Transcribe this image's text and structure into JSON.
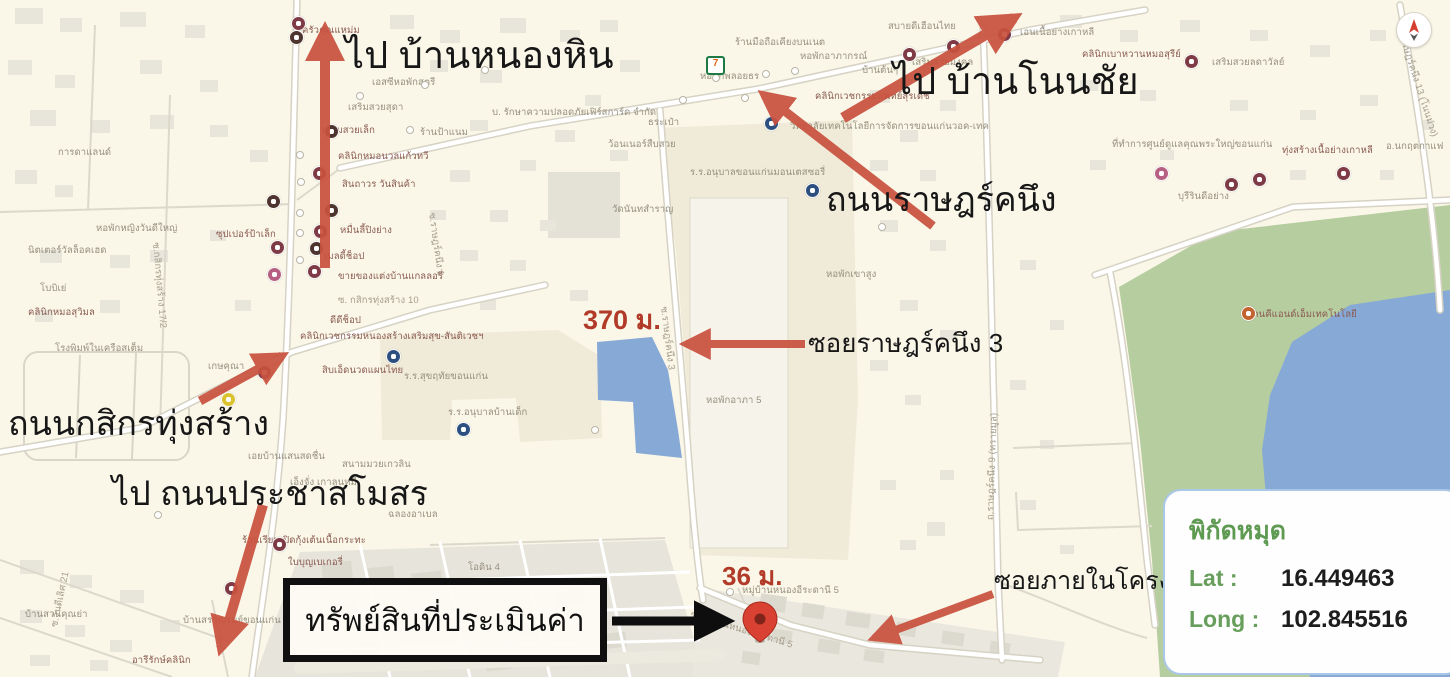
{
  "colors": {
    "background": "#faf7e9",
    "road": "#ffffff",
    "road_casing": "#dbd7ca",
    "building": "#e8e5db",
    "campus": "#f0ead8",
    "park": "#b6cd9f",
    "water": "#87a9d6",
    "arrow_red": "#c9523f",
    "arrow_black": "#0e0e0e",
    "pin_red": "#d94132",
    "annotation_red": "#b23a28",
    "coords_green": "#679e5b"
  },
  "annotations": {
    "to_ban_nong_hin": "ไป บ้านหนองหิน",
    "to_ban_non_chai": "ไป บ้านโนนชัย",
    "ratchakhanueng_road": "ถนนราษฎร์คนึง",
    "soi_ratchakhanueng_3": "ซอยราษฎร์คนึง 3",
    "distance_370": "370 ม.",
    "kasikorn_thungsang_road": "ถนนกสิกรทุ่งสร้าง",
    "to_pracha_samosorn": "ไป ถนนประชาสโมสร",
    "property_appraised": "ทรัพย์สินที่ประเมินค่า",
    "distance_36": "36 ม.",
    "soi_inside_project": "ซอยภายในโครงการ"
  },
  "coords_box": {
    "title": "พิกัดหมุด",
    "lat_label": "Lat :",
    "lat_value": "16.449463",
    "long_label": "Long :",
    "long_value": "102.845516"
  },
  "seven_eleven": {
    "x": 706,
    "y": 56,
    "glyph": "7"
  },
  "poi_colors": {
    "m": "#7e3a45",
    "b": "#4e342e",
    "p": "#b75f82",
    "s": "#2d4f80",
    "o": "#c2622f",
    "y": "#d9c22e"
  },
  "pois": [
    {
      "x": 297,
      "y": 22,
      "c": "m"
    },
    {
      "x": 295,
      "y": 36,
      "c": "b"
    },
    {
      "x": 272,
      "y": 200,
      "c": "b"
    },
    {
      "x": 276,
      "y": 246,
      "c": "m"
    },
    {
      "x": 273,
      "y": 273,
      "c": "p"
    },
    {
      "x": 318,
      "y": 172,
      "c": "m"
    },
    {
      "x": 330,
      "y": 209,
      "c": "b"
    },
    {
      "x": 319,
      "y": 230,
      "c": "m"
    },
    {
      "x": 315,
      "y": 247,
      "c": "b"
    },
    {
      "x": 313,
      "y": 270,
      "c": "m"
    },
    {
      "x": 263,
      "y": 371,
      "c": "m"
    },
    {
      "x": 278,
      "y": 543,
      "c": "m"
    },
    {
      "x": 230,
      "y": 587,
      "c": "m"
    },
    {
      "x": 330,
      "y": 130,
      "c": "b"
    },
    {
      "x": 908,
      "y": 53,
      "c": "m"
    },
    {
      "x": 952,
      "y": 45,
      "c": "m"
    },
    {
      "x": 1003,
      "y": 33,
      "c": "m"
    },
    {
      "x": 1190,
      "y": 60,
      "c": "m"
    },
    {
      "x": 1160,
      "y": 172,
      "c": "p"
    },
    {
      "x": 1230,
      "y": 183,
      "c": "m"
    },
    {
      "x": 1258,
      "y": 178,
      "c": "m"
    },
    {
      "x": 1342,
      "y": 172,
      "c": "m"
    },
    {
      "x": 1247,
      "y": 312,
      "c": "o"
    },
    {
      "x": 770,
      "y": 122,
      "c": "s"
    },
    {
      "x": 811,
      "y": 189,
      "c": "s"
    },
    {
      "x": 392,
      "y": 355,
      "c": "s"
    },
    {
      "x": 462,
      "y": 428,
      "c": "s"
    },
    {
      "x": 227,
      "y": 398,
      "c": "y"
    }
  ],
  "dots": [
    {
      "x": 360,
      "y": 96
    },
    {
      "x": 425,
      "y": 85
    },
    {
      "x": 485,
      "y": 70
    },
    {
      "x": 410,
      "y": 130
    },
    {
      "x": 300,
      "y": 155
    },
    {
      "x": 301,
      "y": 182
    },
    {
      "x": 300,
      "y": 213
    },
    {
      "x": 300,
      "y": 233
    },
    {
      "x": 300,
      "y": 260
    },
    {
      "x": 683,
      "y": 100
    },
    {
      "x": 716,
      "y": 78
    },
    {
      "x": 745,
      "y": 98
    },
    {
      "x": 766,
      "y": 74
    },
    {
      "x": 795,
      "y": 71
    },
    {
      "x": 730,
      "y": 592
    },
    {
      "x": 882,
      "y": 227
    },
    {
      "x": 158,
      "y": 515
    },
    {
      "x": 595,
      "y": 430
    }
  ],
  "map_labels": [
    {
      "t": "การดาแลนด์",
      "x": 58,
      "y": 148
    },
    {
      "t": "หอพักหญิงวันดีใหญ่",
      "x": 96,
      "y": 224
    },
    {
      "t": "ครัวคุณแหม่ม",
      "x": 302,
      "y": 26,
      "k": "p"
    },
    {
      "t": "เอสซีหอพักสตรี",
      "x": 372,
      "y": 78
    },
    {
      "t": "บ. รักษาความปลอดภัยเฟิร์สการ์ด จำกัด",
      "x": 492,
      "y": 108
    },
    {
      "t": "เสริมสวยสุดา",
      "x": 348,
      "y": 103
    },
    {
      "t": "เสริมสวยเล็ก",
      "x": 322,
      "y": 126,
      "k": "p"
    },
    {
      "t": "ร้านป้าแนม",
      "x": 420,
      "y": 128
    },
    {
      "t": "ซุปเปอร์ป้าเล็ก",
      "x": 216,
      "y": 230,
      "k": "p"
    },
    {
      "t": "นิตเตอร์วัลล็อคเฮด",
      "x": 28,
      "y": 246
    },
    {
      "t": "โบบิเย่",
      "x": 40,
      "y": 284
    },
    {
      "t": "คลินิกหมอสุวิมล",
      "x": 28,
      "y": 308,
      "k": "p"
    },
    {
      "t": "คลินิกหมอนวลแก้วทวี",
      "x": 338,
      "y": 152,
      "k": "p"
    },
    {
      "t": "สินถาวร วันสินค้า",
      "x": 342,
      "y": 180,
      "k": "p"
    },
    {
      "t": "หมื่นลี้ปิงย่าง",
      "x": 340,
      "y": 226,
      "k": "p"
    },
    {
      "t": "เมลดี้ช็อป",
      "x": 324,
      "y": 252,
      "k": "p"
    },
    {
      "t": "ขายของแต่งบ้านแกลลอรี่",
      "x": 338,
      "y": 272,
      "k": "p"
    },
    {
      "t": "ซ. กสิกรทุ่งสร้าง 10",
      "x": 338,
      "y": 296,
      "k": "r"
    },
    {
      "t": "ดีดีช็อป",
      "x": 330,
      "y": 316,
      "k": "p"
    },
    {
      "t": "คลินิกเวชกรรมหนองสร้างเสริมสุข-สันติเวชฯ",
      "x": 300,
      "y": 332,
      "k": "p"
    },
    {
      "t": "โรงพิมพ์ในเครือสเต็ม",
      "x": 55,
      "y": 344
    },
    {
      "t": "เกษคุณา",
      "x": 208,
      "y": 362
    },
    {
      "t": "สิบเอ็ดนวดแผนไทย",
      "x": 322,
      "y": 366,
      "k": "p"
    },
    {
      "t": "ร.ร.สุขฤทัยขอนแก่น",
      "x": 404,
      "y": 372
    },
    {
      "t": "ร.ร.อนุบาลบ้านเด็ก",
      "x": 448,
      "y": 408
    },
    {
      "t": "เอยบ้านแสนสดชื่น",
      "x": 248,
      "y": 452
    },
    {
      "t": "สนามมวยเกวลิน",
      "x": 342,
      "y": 460
    },
    {
      "t": "เอ็งจั่ง เกาลูนหมี",
      "x": 290,
      "y": 478
    },
    {
      "t": "ฉลองอาเบล",
      "x": 388,
      "y": 510
    },
    {
      "t": "ร้านเรียมเปิดกุ้งเต้นเนื้อกระทะ",
      "x": 242,
      "y": 536,
      "k": "p"
    },
    {
      "t": "ใบบุญเบเกอรี่",
      "x": 288,
      "y": 558,
      "k": "p"
    },
    {
      "t": "โอดิน 4",
      "x": 468,
      "y": 563
    },
    {
      "t": "บ้านสราญรมย์ขอนแก่น",
      "x": 183,
      "y": 616
    },
    {
      "t": "อารีรักษ์คลินิก",
      "x": 132,
      "y": 656,
      "k": "p"
    },
    {
      "t": "บ้านสวนคุณย่า",
      "x": 25,
      "y": 610
    },
    {
      "t": "ธระเป๋า",
      "x": 648,
      "y": 118
    },
    {
      "t": "ว้อนเนอร์สืบสวย",
      "x": 608,
      "y": 140
    },
    {
      "t": "วัดนันทสำราญ",
      "x": 612,
      "y": 205
    },
    {
      "t": "หอพักพลอยธร",
      "x": 700,
      "y": 72
    },
    {
      "t": "ร้านมือถือเคียงบนเนต",
      "x": 735,
      "y": 38
    },
    {
      "t": "หอพักอาภากรณ์",
      "x": 800,
      "y": 52
    },
    {
      "t": "คลินิกเวชกรรมแพทย์สุรเดช",
      "x": 815,
      "y": 92,
      "k": "p"
    },
    {
      "t": "วิทยาลัยเทคโนโลยีการจัดการขอนแก่นวอค-เทค",
      "x": 790,
      "y": 122
    },
    {
      "t": "ร.ร.อนุบาลขอนแก่นมอนเตสซอรี่",
      "x": 690,
      "y": 168
    },
    {
      "t": "หอพักเขาสูง",
      "x": 826,
      "y": 270
    },
    {
      "t": "หอพักอาภา 5",
      "x": 706,
      "y": 396
    },
    {
      "t": "สบายดีเฮือนไทย",
      "x": 888,
      "y": 22
    },
    {
      "t": "เสริมสวยมงคล",
      "x": 912,
      "y": 58
    },
    {
      "t": "บ้านต้นๆ",
      "x": 862,
      "y": 66
    },
    {
      "t": "เอนเนื้อย่างเกาหลี",
      "x": 1020,
      "y": 28
    },
    {
      "t": "คลินิกเบาหวานหมอสุรีย์",
      "x": 1082,
      "y": 50,
      "k": "p"
    },
    {
      "t": "เสริมสวยลดาวัลย์",
      "x": 1212,
      "y": 58
    },
    {
      "t": "ที่ทำการศูนย์ดูแลคุณพระใหญ่ขอนแก่น",
      "x": 1112,
      "y": 140
    },
    {
      "t": "ทุ่งสร้างเนื้อย่างเกาหลี",
      "x": 1282,
      "y": 146,
      "k": "p"
    },
    {
      "t": "อ.นกฤตกาแฟ",
      "x": 1386,
      "y": 142
    },
    {
      "t": "บุรีรินดีอย่าง",
      "x": 1178,
      "y": 192
    },
    {
      "t": "ร้านคีแอนด์เอ็มเทคโนโลยี",
      "x": 1248,
      "y": 310,
      "k": "p"
    },
    {
      "t": "หมู่บ้านหนองอีระดานี 5",
      "x": 742,
      "y": 586
    },
    {
      "t": "ซ.ราษฎร์คนึง 3",
      "x": 668,
      "y": 306,
      "k": "r",
      "r": 83
    },
    {
      "t": "ซ.ราษฎร์คนึง 1",
      "x": 436,
      "y": 212,
      "k": "r",
      "r": 82
    },
    {
      "t": "ถ.ราษฎร์คนึง 9 (ทรายมูล)",
      "x": 986,
      "y": 520,
      "k": "r",
      "r": -88
    },
    {
      "t": "ถ.ราษฎร์คนึง 13 (โนนม่วง)",
      "x": 1404,
      "y": 28,
      "k": "r",
      "r": 72
    },
    {
      "t": "ซ.กสิกรทุ่งสร้าง 17/2",
      "x": 160,
      "y": 242,
      "k": "r",
      "r": 85
    },
    {
      "t": "ซ.วันดีเลิศ 21",
      "x": 50,
      "y": 626,
      "k": "r",
      "r": -78
    },
    {
      "t": "ซ.หมู่บ้านหนองอีระดานี 5",
      "x": 692,
      "y": 610,
      "k": "r",
      "r": 17
    }
  ]
}
